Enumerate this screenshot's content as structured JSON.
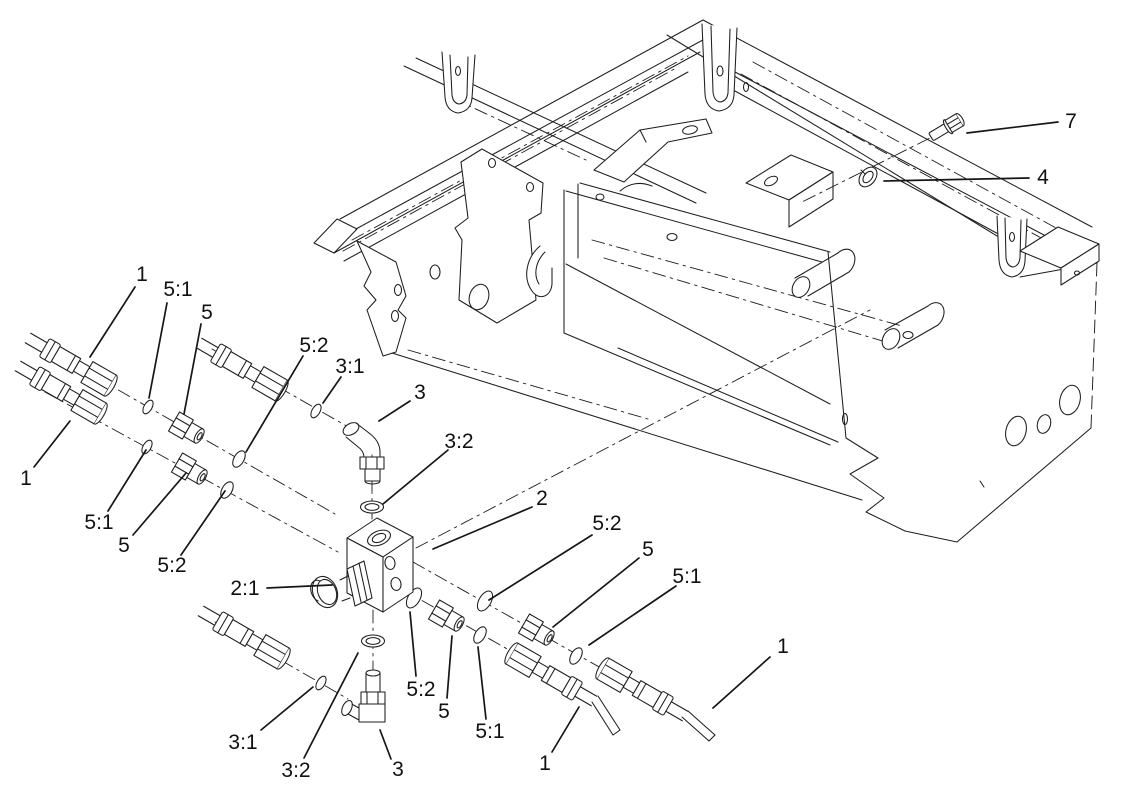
{
  "figure": {
    "type": "exploded-parts-diagram",
    "background": "#ffffff",
    "line_color": "#1e1e1e",
    "callouts": [
      {
        "label": "1",
        "x": 142,
        "y": 274,
        "leader": [
          135,
          287,
          90,
          357
        ]
      },
      {
        "label": "5:1",
        "x": 178,
        "y": 289,
        "leader": [
          167,
          303,
          149,
          398
        ]
      },
      {
        "label": "5",
        "x": 207,
        "y": 312,
        "leader": [
          201,
          324,
          184,
          414
        ]
      },
      {
        "label": "5:2",
        "x": 314,
        "y": 345,
        "leader": [
          303,
          356,
          246,
          452
        ]
      },
      {
        "label": "3:1",
        "x": 350,
        "y": 366,
        "leader": [
          341,
          377,
          323,
          403
        ]
      },
      {
        "label": "3",
        "x": 420,
        "y": 392,
        "leader": [
          410,
          401,
          379,
          421
        ]
      },
      {
        "label": "3:2",
        "x": 459,
        "y": 441,
        "leader": [
          448,
          450,
          383,
          504
        ]
      },
      {
        "label": "2",
        "x": 542,
        "y": 498,
        "leader": [
          532,
          507,
          433,
          549
        ]
      },
      {
        "label": "2:1",
        "x": 245,
        "y": 588,
        "leader": [
          267,
          588,
          332,
          585
        ]
      },
      {
        "label": "1",
        "x": 26,
        "y": 478,
        "leader": [
          34,
          467,
          70,
          421
        ]
      },
      {
        "label": "5:1",
        "x": 99,
        "y": 522,
        "leader": [
          108,
          511,
          146,
          450
        ]
      },
      {
        "label": "5",
        "x": 124,
        "y": 545,
        "leader": [
          133,
          535,
          186,
          473
        ]
      },
      {
        "label": "5:2",
        "x": 172,
        "y": 565,
        "leader": [
          181,
          555,
          225,
          491
        ]
      },
      {
        "label": "3:1",
        "x": 243,
        "y": 742,
        "leader": [
          261,
          730,
          313,
          687
        ]
      },
      {
        "label": "3:2",
        "x": 296,
        "y": 770,
        "leader": [
          304,
          758,
          358,
          653
        ]
      },
      {
        "label": "3",
        "x": 398,
        "y": 769,
        "leader": [
          391,
          759,
          380,
          730
        ]
      },
      {
        "label": "5:2",
        "x": 421,
        "y": 689,
        "leader": [
          416,
          676,
          410,
          612
        ]
      },
      {
        "label": "5",
        "x": 444,
        "y": 711,
        "leader": [
          447,
          698,
          452,
          636
        ]
      },
      {
        "label": "5:1",
        "x": 490,
        "y": 731,
        "leader": [
          486,
          719,
          478,
          647
        ]
      },
      {
        "label": "1",
        "x": 545,
        "y": 763,
        "leader": [
          552,
          752,
          579,
          707
        ]
      },
      {
        "label": "5:2",
        "x": 607,
        "y": 523,
        "leader": [
          592,
          535,
          489,
          600
        ]
      },
      {
        "label": "5",
        "x": 648,
        "y": 549,
        "leader": [
          639,
          558,
          553,
          627
        ]
      },
      {
        "label": "5:1",
        "x": 687,
        "y": 576,
        "leader": [
          676,
          586,
          589,
          645
        ]
      },
      {
        "label": "1",
        "x": 783,
        "y": 646,
        "leader": [
          770,
          657,
          713,
          708
        ]
      },
      {
        "label": "7",
        "x": 1071,
        "y": 121,
        "leader": [
          1058,
          122,
          967,
          133
        ]
      },
      {
        "label": "4",
        "x": 1043,
        "y": 177,
        "leader": [
          1029,
          178,
          884,
          181
        ]
      }
    ]
  }
}
